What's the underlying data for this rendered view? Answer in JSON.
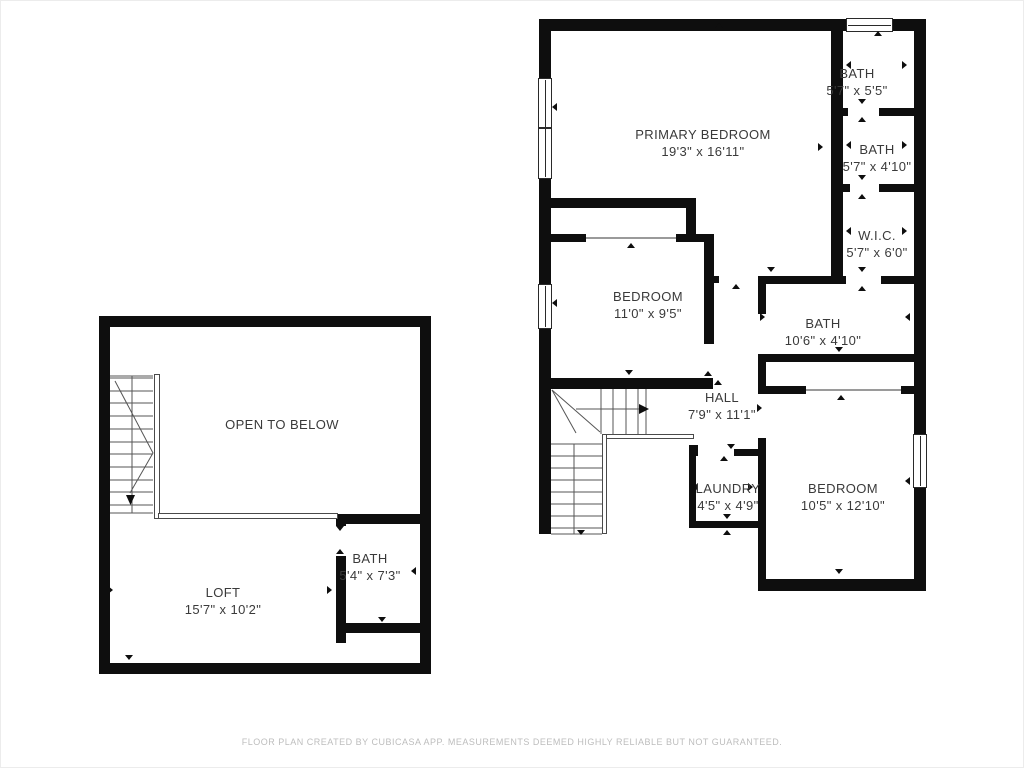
{
  "document_type": "floor-plan",
  "colors": {
    "wall": "#0e0e0e",
    "room_text": "#3a3a3a",
    "stair_line": "#555555",
    "footer_text": "#bdbdbd",
    "background": "#ffffff"
  },
  "floor_plans": {
    "upper_floor": {
      "rooms": [
        {
          "name": "PRIMARY BEDROOM",
          "dims": "19'3\" x 16'11\""
        },
        {
          "name": "BATH",
          "dims": "5'7\" x 5'5\""
        },
        {
          "name": "BATH",
          "dims": "5'7\" x 4'10\""
        },
        {
          "name": "W.I.C.",
          "dims": "5'7\" x 6'0\""
        },
        {
          "name": "BEDROOM",
          "dims": "11'0\" x 9'5\""
        },
        {
          "name": "BATH",
          "dims": "10'6\" x 4'10\""
        },
        {
          "name": "HALL",
          "dims": "7'9\" x 11'1\""
        },
        {
          "name": "LAUNDRY",
          "dims": "4'5\" x 4'9\""
        },
        {
          "name": "BEDROOM",
          "dims": "10'5\" x 12'10\""
        }
      ]
    },
    "loft_floor": {
      "rooms": [
        {
          "name": "OPEN TO BELOW",
          "dims": ""
        },
        {
          "name": "LOFT",
          "dims": "15'7\" x 10'2\""
        },
        {
          "name": "BATH",
          "dims": "5'4\" x 7'3\""
        }
      ]
    }
  },
  "footer": {
    "disclaimer": "FLOOR PLAN CREATED BY CUBICASA APP. MEASUREMENTS DEEMED HIGHLY RELIABLE BUT NOT GUARANTEED."
  }
}
